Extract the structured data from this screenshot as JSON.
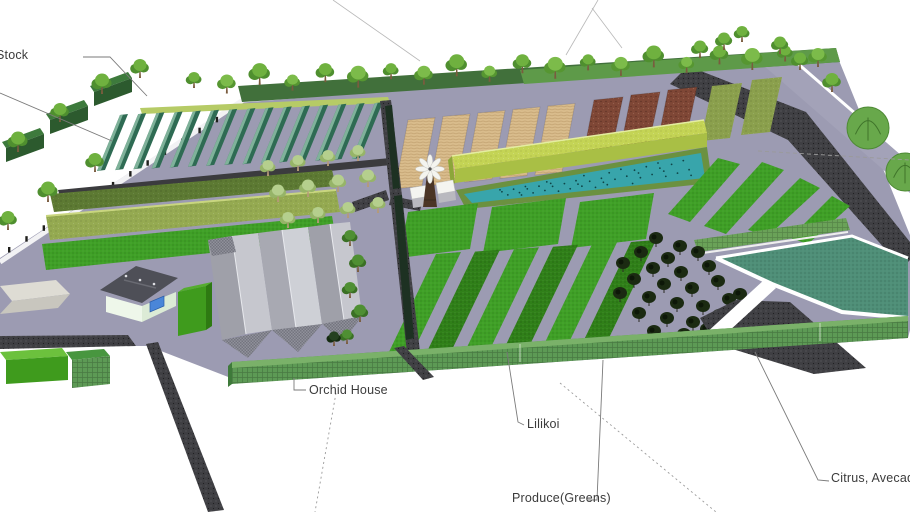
{
  "viewport": {
    "width": 910,
    "height": 512,
    "background": "#ffffff"
  },
  "labels": {
    "stock": "Stock",
    "orchid_house": "Orchid House",
    "lilikoi": "Lilikoi",
    "produce_greens": "Produce(Greens)",
    "citrus_avocado": "Citrus, Avecado"
  },
  "palette": {
    "ground": "#9c9bb2",
    "gravel": "#3f3f43",
    "path_white": "#f2f2f4",
    "field_bright_green": "#3fa026",
    "field_medium_green": "#308019",
    "field_tan": "#d9bc8c",
    "field_brown": "#7f4736",
    "field_olive": "#8ba04d",
    "shade_structure_chartreuse": "#c4d455",
    "pond_teal": "#38a5ab",
    "citrus_field_teal": "#4f8f78",
    "hedge_green": "#5d9a55",
    "tree_green": "#6fb13f",
    "roof_gray": "#c6c7ce"
  },
  "features": [
    "perimeter-tree-row",
    "stock-hedges",
    "greenhouse-crop-rows",
    "field-strips",
    "orchard",
    "windmill",
    "shade-house",
    "aquaculture-pond",
    "tilled-plots",
    "compost-plots",
    "produce-rows",
    "barn-complex",
    "farm-house",
    "storage-shed",
    "equipment-pads",
    "citrus-avocado-field",
    "orchid-house-shadehouse",
    "perimeter-road"
  ]
}
